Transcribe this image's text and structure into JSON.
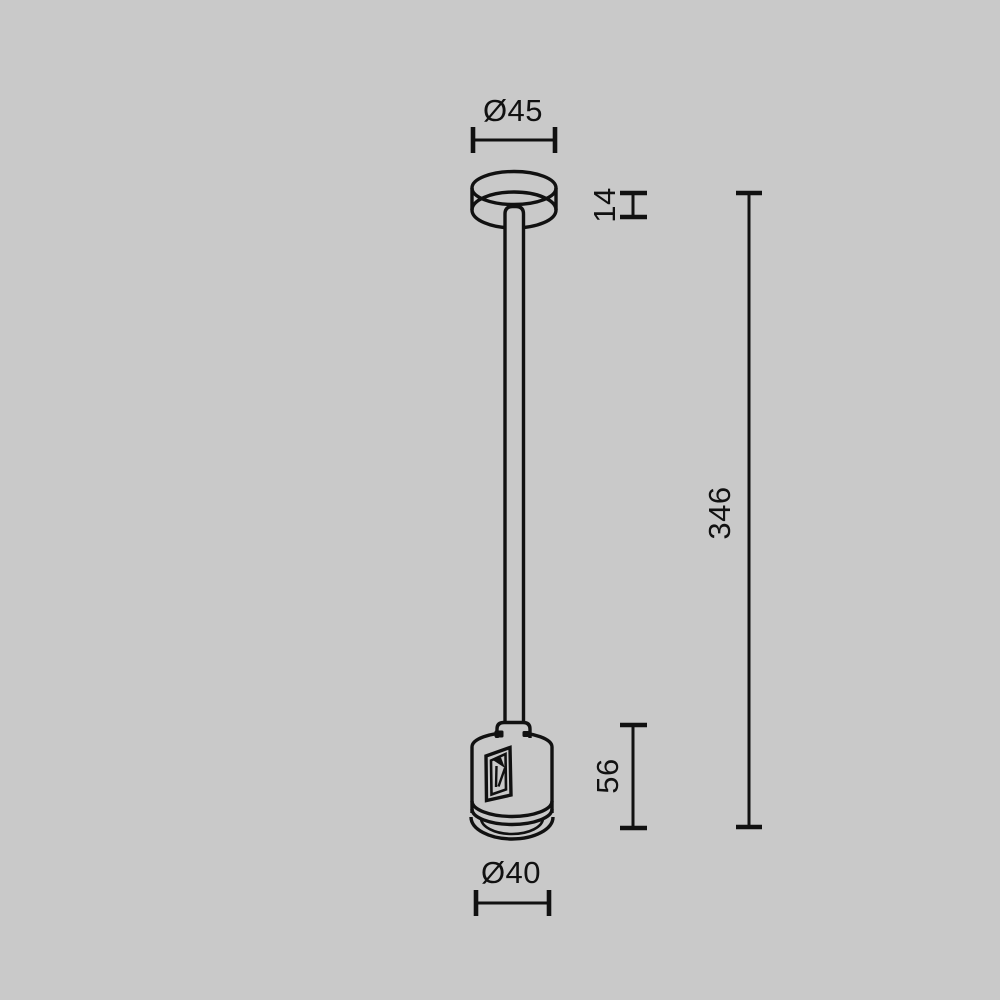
{
  "colors": {
    "background": "#c9c9c9",
    "line": "#111111"
  },
  "drawing": {
    "dimensions": {
      "canopy_diameter": "Ø45",
      "canopy_height": "14",
      "overall_length": "346",
      "connector_height": "56",
      "connector_diameter": "Ø40"
    }
  }
}
